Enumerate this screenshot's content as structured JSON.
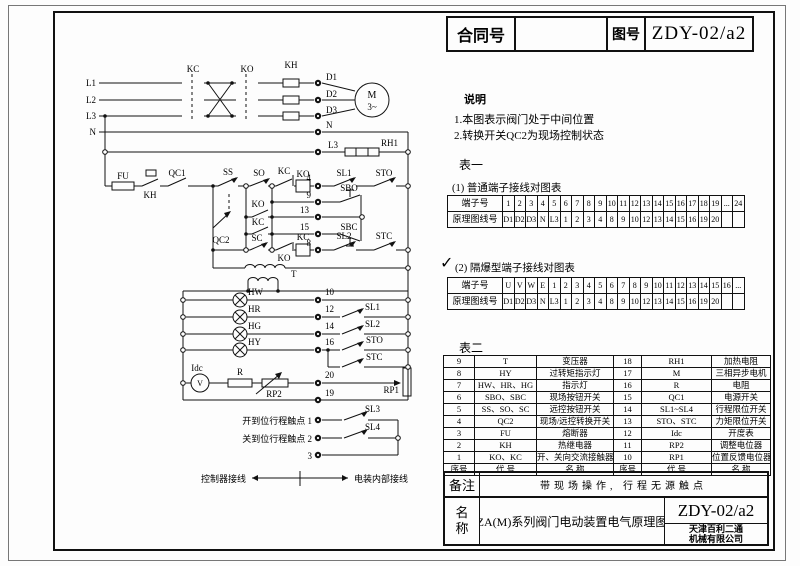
{
  "title_block": {
    "contract_label": "合同号",
    "contract_value": "",
    "drawing_label": "图号",
    "drawing_value": "ZDY-02/a2"
  },
  "notes": {
    "heading": "说明",
    "items": [
      "1.本图表示阀门处于中间位置",
      "2.转换开关QC2为现场控制状态"
    ]
  },
  "table1": {
    "heading": "表一",
    "caption": "(1)   普通端子接线对图表",
    "terminal_label": "端子号",
    "wire_label": "原理图线号",
    "terminals": [
      "1",
      "2",
      "3",
      "4",
      "5",
      "6",
      "7",
      "8",
      "9",
      "10",
      "11",
      "12",
      "13",
      "14",
      "15",
      "16",
      "17",
      "18",
      "19",
      "...",
      "24"
    ],
    "wires": [
      "D1",
      "D2",
      "D3",
      "N",
      "L3",
      "1",
      "2",
      "3",
      "4",
      "8",
      "9",
      "10",
      "12",
      "13",
      "14",
      "15",
      "16",
      "19",
      "20",
      "",
      ""
    ]
  },
  "table2": {
    "check": "✓",
    "caption": "(2)   隔爆型端子接线对图表",
    "terminal_label": "端子号",
    "wire_label": "原理图线号",
    "terminals": [
      "U",
      "V",
      "W",
      "E",
      "1",
      "2",
      "3",
      "4",
      "5",
      "6",
      "7",
      "8",
      "9",
      "10",
      "11",
      "12",
      "13",
      "14",
      "15",
      "16",
      "..."
    ],
    "wires": [
      "D1",
      "D2",
      "D3",
      "N",
      "L3",
      "1",
      "2",
      "3",
      "4",
      "8",
      "9",
      "10",
      "12",
      "13",
      "14",
      "15",
      "16",
      "19",
      "20",
      "",
      ""
    ]
  },
  "component_table": {
    "heading": "表二",
    "rows": [
      [
        "9",
        "T",
        "变压器",
        "18",
        "RH1",
        "加热电阻"
      ],
      [
        "8",
        "HY",
        "过转矩指示灯",
        "17",
        "M",
        "三相异步电机"
      ],
      [
        "7",
        "HW、HR、HG",
        "指示灯",
        "16",
        "R",
        "电阻"
      ],
      [
        "6",
        "SBO、SBC",
        "现场按钮开关",
        "15",
        "QC1",
        "电源开关"
      ],
      [
        "5",
        "SS、SO、SC",
        "远控按钮开关",
        "14",
        "SL1~SL4",
        "行程限位开关"
      ],
      [
        "4",
        "QC2",
        "现场/远控转换开关",
        "13",
        "STO、STC",
        "力矩限位开关"
      ],
      [
        "3",
        "FU",
        "熔断器",
        "12",
        "Idc",
        "开度表"
      ],
      [
        "2",
        "KH",
        "热继电器",
        "11",
        "RP2",
        "调整电位器"
      ],
      [
        "1",
        "KO、KC",
        "开、关向交流接触器",
        "10",
        "RP1",
        "位置反馈电位器"
      ]
    ],
    "footer": [
      "序号",
      "代 号",
      "名 称",
      "序号",
      "代 号",
      "名 称"
    ]
  },
  "remark": {
    "label": "备注",
    "text": "带现场操作, 行程无源触点"
  },
  "name_block": {
    "label_line1": "名",
    "label_line2": "称",
    "value": "ZA(M)系列阀门电动装置电气原理图",
    "drawing_no": "ZDY-02/a2",
    "company_line1": "天津百利二通",
    "company_line2": "机械有限公司"
  },
  "schematic": {
    "labels": {
      "l1": "L1",
      "l2": "L2",
      "l3": "L3",
      "n": "N",
      "kc": "KC",
      "ko": "KO",
      "kh": "KH",
      "d1": "D1",
      "d2": "D2",
      "d3": "D3",
      "m": "M",
      "m3": "3~",
      "rh1": "RH1",
      "fu": "FU",
      "qc1": "QC1",
      "qc2": "QC2",
      "ss": "SS",
      "so": "SO",
      "sc": "SC",
      "sbo": "SBO",
      "sbc": "SBC",
      "t": "T",
      "hw": "HW",
      "hr": "HR",
      "hg": "HG",
      "hy": "HY",
      "sl1": "SL1",
      "sl2": "SL2",
      "sl3": "SL3",
      "sl4": "SL4",
      "sto": "STO",
      "stc": "STC",
      "idc": "Idc",
      "v": "V",
      "r": "R",
      "rp1": "RP1",
      "rp2": "RP2",
      "n1": "1",
      "n2": "2",
      "n3": "3",
      "n4": "4",
      "n8": "8",
      "n9": "9",
      "n10": "10",
      "n12": "12",
      "n13": "13",
      "n14": "14",
      "n15": "15",
      "n16": "16",
      "n19": "19",
      "n20": "20",
      "open_limit": "开到位行程触点 1",
      "close_limit": "关到位行程触点 2",
      "legend_left": "控制器接线",
      "legend_right": "电装内部接线"
    }
  }
}
